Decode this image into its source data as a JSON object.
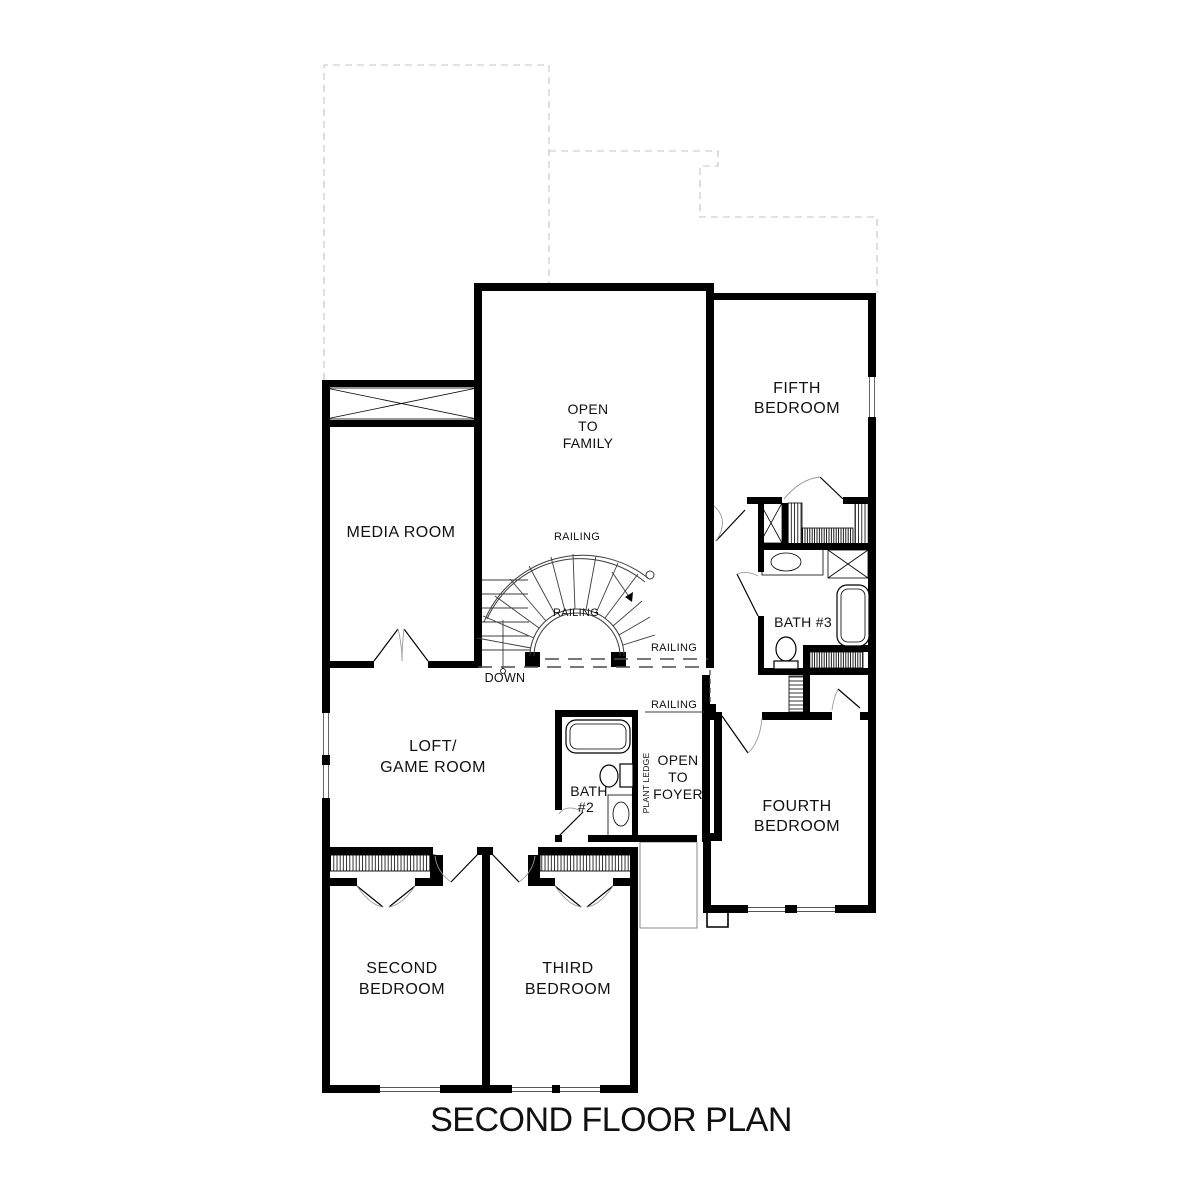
{
  "meta": {
    "background_color": "#ffffff",
    "wall_color": "#000000",
    "roof_outline_color": "#c4c4c4"
  },
  "title": "SECOND FLOOR PLAN",
  "rooms": {
    "media": {
      "label": "MEDIA ROOM"
    },
    "open_family": {
      "l1": "OPEN",
      "l2": "TO",
      "l3": "FAMILY"
    },
    "fifth": {
      "l1": "FIFTH",
      "l2": "BEDROOM"
    },
    "bath3": {
      "label": "BATH #3"
    },
    "loft": {
      "l1": "LOFT/",
      "l2": "GAME ROOM"
    },
    "bath2": {
      "l1": "BATH",
      "l2": "#2"
    },
    "plant_ledge": {
      "label": "PLANT LEDGE"
    },
    "open_foyer": {
      "l1": "OPEN",
      "l2": "TO",
      "l3": "FOYER"
    },
    "fourth": {
      "l1": "FOURTH",
      "l2": "BEDROOM"
    },
    "second": {
      "l1": "SECOND",
      "l2": "BEDROOM"
    },
    "third": {
      "l1": "THIRD",
      "l2": "BEDROOM"
    }
  },
  "annotations": {
    "railing": "RAILING",
    "down": "DOWN"
  }
}
